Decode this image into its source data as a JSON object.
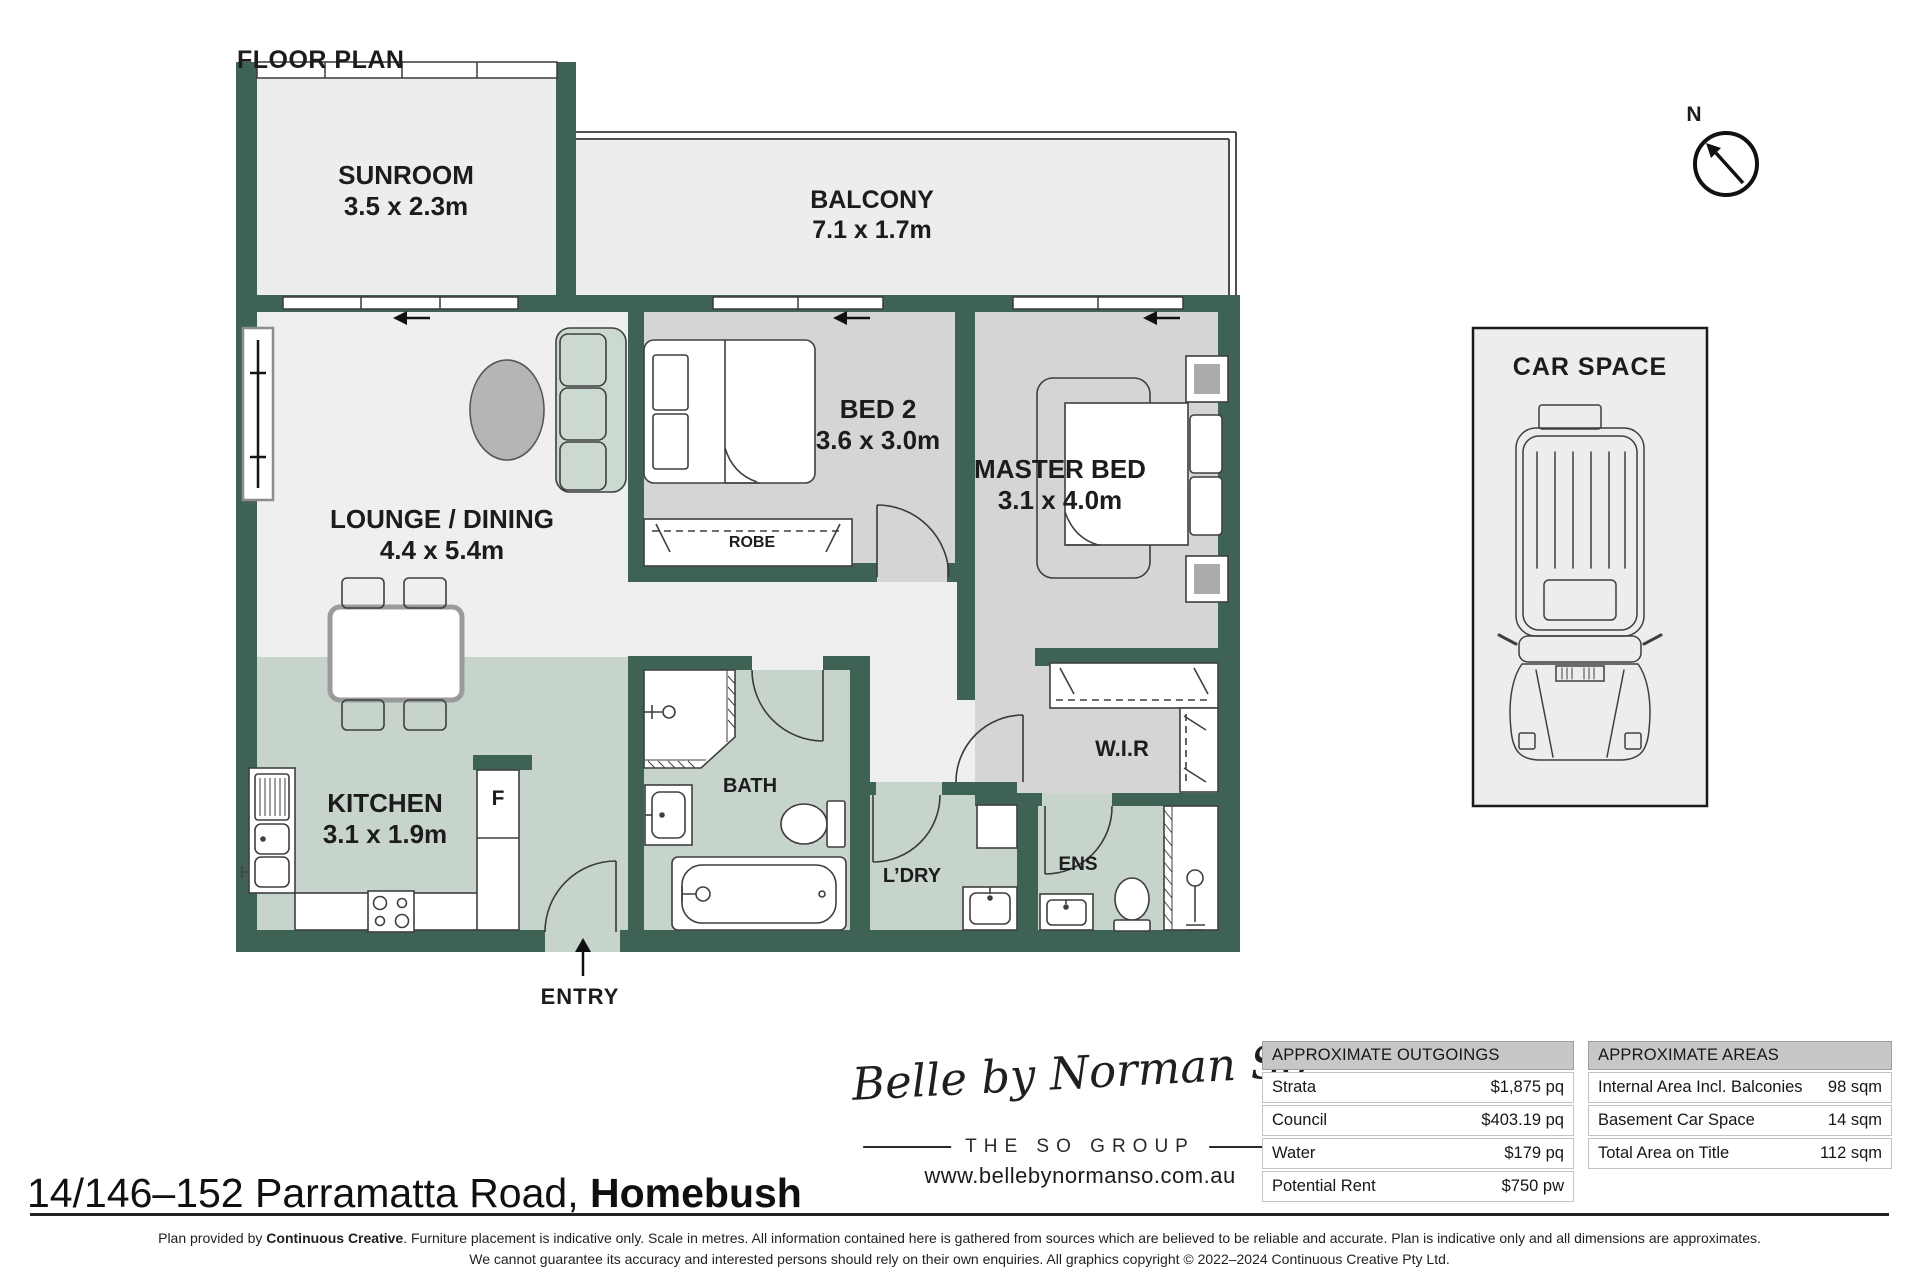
{
  "page_title": "FLOOR PLAN",
  "palette": {
    "wall_green": "#3E6355",
    "floor_light": "#EFEFEF",
    "floor_gray": "#D5D5D5",
    "floor_sage": "#C6D4CC"
  },
  "compass": {
    "label": "N"
  },
  "rooms": {
    "sunroom": {
      "name": "SUNROOM",
      "dims": "3.5 x 2.3m"
    },
    "balcony": {
      "name": "BALCONY",
      "dims": "7.1 x 1.7m"
    },
    "lounge": {
      "name": "LOUNGE / DINING",
      "dims": "4.4 x 5.4m"
    },
    "bed2": {
      "name": "BED 2",
      "dims": "3.6 x 3.0m"
    },
    "master": {
      "name": "MASTER BED",
      "dims": "3.1 x 4.0m"
    },
    "kitchen": {
      "name": "KITCHEN",
      "dims": "3.1 x 1.9m"
    },
    "bath": {
      "name": "BATH"
    },
    "laundry": {
      "name": "L’DRY"
    },
    "ensuite": {
      "name": "ENS"
    },
    "wir": {
      "name": "W.I.R"
    },
    "robe": {
      "name": "ROBE"
    },
    "entry": {
      "name": "ENTRY"
    },
    "fridge": {
      "name": "F"
    }
  },
  "car_space": {
    "title": "CAR SPACE"
  },
  "branding": {
    "script": "Belle by Norman So",
    "group": "THE SO GROUP",
    "website": "www.bellebynormanso.com.au"
  },
  "address": {
    "street": "14/146–152 Parramatta Road, ",
    "suburb": "Homebush"
  },
  "outgoings": {
    "title": "APPROXIMATE OUTGOINGS",
    "rows": [
      {
        "label": "Strata",
        "value": "$1,875 pq"
      },
      {
        "label": "Council",
        "value": "$403.19 pq"
      },
      {
        "label": "Water",
        "value": "$179 pq"
      },
      {
        "label": "Potential Rent",
        "value": "$750 pw"
      }
    ]
  },
  "areas": {
    "title": "APPROXIMATE AREAS",
    "rows": [
      {
        "label": "Internal Area Incl. Balconies",
        "value": "98 sqm"
      },
      {
        "label": "Basement Car Space",
        "value": "14 sqm"
      },
      {
        "label": "Total Area on Title",
        "value": "112 sqm"
      }
    ]
  },
  "footer": {
    "line1_pre": "Plan provided by ",
    "line1_bold": "Continuous Creative",
    "line1_post": ". Furniture placement is indicative only. Scale in metres. All information contained here is gathered from sources which are believed to be reliable and accurate. Plan is indicative only and all dimensions are approximates.",
    "line2": "We cannot guarantee its accuracy and interested persons should rely on their own enquiries. All graphics copyright © 2022–2024 Continuous Creative Pty Ltd."
  }
}
